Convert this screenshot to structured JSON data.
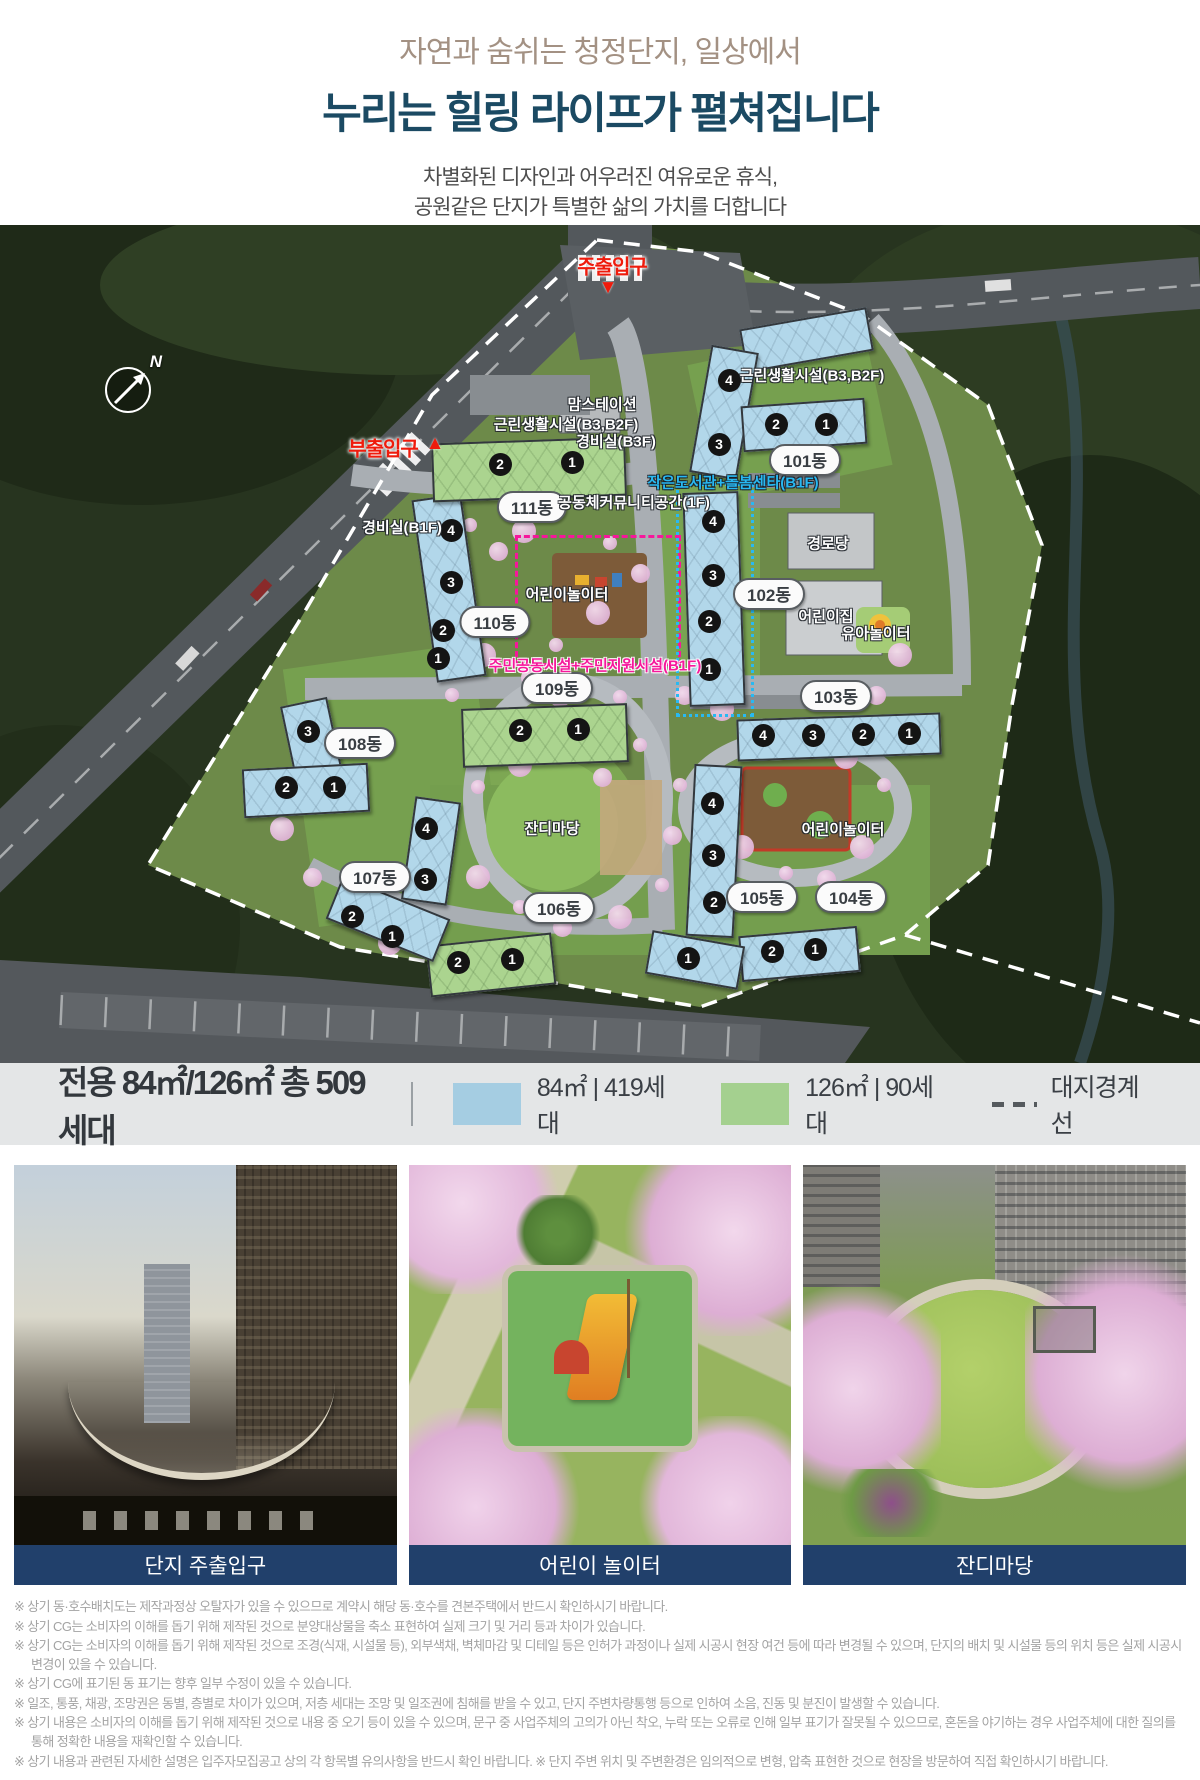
{
  "header": {
    "line1": "자연과 숨쉬는 청정단지, 일상에서",
    "line2": "누리는 힐링 라이프가 펼쳐집니다",
    "line3": "차별화된 디자인과 어우러진 여유로운 휴식,",
    "line4": "공원같은 단지가 특별한 삶의 가치를 더합니다"
  },
  "map": {
    "compass_label": "N",
    "entrances": [
      {
        "label": "주출입구",
        "x": 612,
        "y": 40,
        "dir": "down",
        "tx": 608,
        "ty": 63
      },
      {
        "label": "부출입구",
        "x": 383,
        "y": 222,
        "dir": "up",
        "tx": 435,
        "ty": 219
      }
    ],
    "pills": [
      {
        "label": "101동",
        "x": 805,
        "y": 235
      },
      {
        "label": "102동",
        "x": 769,
        "y": 369
      },
      {
        "label": "103동",
        "x": 836,
        "y": 471
      },
      {
        "label": "104동",
        "x": 851,
        "y": 672
      },
      {
        "label": "105동",
        "x": 762,
        "y": 672
      },
      {
        "label": "106동",
        "x": 559,
        "y": 683
      },
      {
        "label": "107동",
        "x": 375,
        "y": 652
      },
      {
        "label": "108동",
        "x": 360,
        "y": 518
      },
      {
        "label": "109동",
        "x": 557,
        "y": 463
      },
      {
        "label": "110동",
        "x": 495,
        "y": 397
      },
      {
        "label": "111동",
        "x": 532,
        "y": 282
      }
    ],
    "labels": [
      {
        "text": "맘스테이션",
        "style": "white",
        "x": 602,
        "y": 179
      },
      {
        "text": "근린생활시설(B3,B2F)",
        "style": "white",
        "x": 566,
        "y": 199
      },
      {
        "text": "경비실(B3F)",
        "style": "white",
        "x": 616,
        "y": 216
      },
      {
        "text": "근린생활시설(B3,B2F)",
        "style": "white",
        "x": 812,
        "y": 150
      },
      {
        "text": "경비실(B1F)",
        "style": "white",
        "x": 402,
        "y": 302
      },
      {
        "text": "공동체커뮤니티공간(1F)",
        "style": "white",
        "x": 634,
        "y": 277
      },
      {
        "text": "경로당",
        "style": "white",
        "x": 828,
        "y": 318
      },
      {
        "text": "어린이집",
        "style": "white",
        "x": 826,
        "y": 391
      },
      {
        "text": "유아놀이터",
        "style": "white",
        "x": 876,
        "y": 408
      },
      {
        "text": "어린이놀이터",
        "style": "white",
        "x": 567,
        "y": 369
      },
      {
        "text": "잔디마당",
        "style": "white",
        "x": 552,
        "y": 603
      },
      {
        "text": "어린이놀이터",
        "style": "white",
        "x": 843,
        "y": 604
      },
      {
        "text": "작은도서관+돌봄센타(B1F)",
        "style": "cyan",
        "x": 733,
        "y": 257
      },
      {
        "text": "주민공동시설+주민지원시설(B1F)",
        "style": "magenta",
        "x": 595,
        "y": 440
      }
    ],
    "buildings": [
      {
        "dong": "101",
        "color": "blue",
        "parts": [
          {
            "x": 742,
            "y": 93,
            "w": 125,
            "h": 40,
            "rot": -10
          },
          {
            "x": 700,
            "y": 123,
            "w": 44,
            "h": 125,
            "rot": 10
          },
          {
            "x": 742,
            "y": 177,
            "w": 120,
            "h": 42,
            "rot": -4
          }
        ],
        "units": [
          {
            "n": "4",
            "x": 729,
            "y": 155
          },
          {
            "n": "3",
            "x": 719,
            "y": 219
          },
          {
            "n": "2",
            "x": 776,
            "y": 199
          },
          {
            "n": "1",
            "x": 826,
            "y": 199
          }
        ]
      },
      {
        "dong": "102",
        "color": "blue",
        "parts": [
          {
            "x": 686,
            "y": 267,
            "w": 52,
            "h": 210,
            "rot": -2
          }
        ],
        "units": [
          {
            "n": "4",
            "x": 713,
            "y": 296
          },
          {
            "n": "3",
            "x": 713,
            "y": 350
          },
          {
            "n": "2",
            "x": 709,
            "y": 396
          },
          {
            "n": "1",
            "x": 709,
            "y": 444
          }
        ]
      },
      {
        "dong": "103",
        "color": "blue",
        "parts": [
          {
            "x": 737,
            "y": 491,
            "w": 200,
            "h": 38,
            "rot": -2
          }
        ],
        "units": [
          {
            "n": "4",
            "x": 763,
            "y": 510
          },
          {
            "n": "3",
            "x": 813,
            "y": 510
          },
          {
            "n": "2",
            "x": 863,
            "y": 509
          },
          {
            "n": "1",
            "x": 909,
            "y": 508
          }
        ]
      },
      {
        "dong": "104",
        "color": "blue",
        "parts": [
          {
            "x": 740,
            "y": 706,
            "w": 115,
            "h": 42,
            "rot": -5
          }
        ],
        "units": [
          {
            "n": "2",
            "x": 772,
            "y": 726
          },
          {
            "n": "1",
            "x": 815,
            "y": 724
          }
        ]
      },
      {
        "dong": "105",
        "color": "blue",
        "parts": [
          {
            "x": 690,
            "y": 540,
            "w": 44,
            "h": 168,
            "rot": 3
          },
          {
            "x": 648,
            "y": 713,
            "w": 90,
            "h": 40,
            "rot": 10
          }
        ],
        "units": [
          {
            "n": "4",
            "x": 712,
            "y": 578
          },
          {
            "n": "3",
            "x": 713,
            "y": 630
          },
          {
            "n": "2",
            "x": 714,
            "y": 677
          },
          {
            "n": "1",
            "x": 688,
            "y": 733
          }
        ]
      },
      {
        "dong": "106",
        "color": "green",
        "parts": [
          {
            "x": 428,
            "y": 714,
            "w": 122,
            "h": 48,
            "rot": -6
          }
        ],
        "units": [
          {
            "n": "2",
            "x": 458,
            "y": 737
          },
          {
            "n": "1",
            "x": 512,
            "y": 734
          }
        ]
      },
      {
        "dong": "107",
        "color": "blue",
        "parts": [
          {
            "x": 408,
            "y": 574,
            "w": 42,
            "h": 100,
            "rot": 8
          },
          {
            "x": 330,
            "y": 671,
            "w": 112,
            "h": 42,
            "rot": 22
          }
        ],
        "units": [
          {
            "n": "4",
            "x": 426,
            "y": 603
          },
          {
            "n": "3",
            "x": 425,
            "y": 654
          },
          {
            "n": "2",
            "x": 352,
            "y": 691
          },
          {
            "n": "1",
            "x": 392,
            "y": 711
          }
        ]
      },
      {
        "dong": "108",
        "color": "blue",
        "parts": [
          {
            "x": 288,
            "y": 476,
            "w": 44,
            "h": 78,
            "rot": -12
          },
          {
            "x": 243,
            "y": 541,
            "w": 122,
            "h": 45,
            "rot": -3
          }
        ],
        "units": [
          {
            "n": "3",
            "x": 308,
            "y": 506
          },
          {
            "n": "2",
            "x": 286,
            "y": 562
          },
          {
            "n": "1",
            "x": 334,
            "y": 562
          }
        ]
      },
      {
        "dong": "109",
        "color": "green",
        "parts": [
          {
            "x": 462,
            "y": 481,
            "w": 162,
            "h": 55,
            "rot": -2
          }
        ],
        "units": [
          {
            "n": "2",
            "x": 520,
            "y": 505
          },
          {
            "n": "1",
            "x": 578,
            "y": 504
          }
        ]
      },
      {
        "dong": "110",
        "color": "blue",
        "parts": [
          {
            "x": 424,
            "y": 271,
            "w": 46,
            "h": 180,
            "rot": -8
          }
        ],
        "units": [
          {
            "n": "4",
            "x": 451,
            "y": 305
          },
          {
            "n": "3",
            "x": 451,
            "y": 357
          },
          {
            "n": "2",
            "x": 443,
            "y": 405
          },
          {
            "n": "1",
            "x": 438,
            "y": 433
          }
        ]
      },
      {
        "dong": "111",
        "color": "green",
        "parts": [
          {
            "x": 432,
            "y": 215,
            "w": 190,
            "h": 55,
            "rot": -2
          }
        ],
        "units": [
          {
            "n": "2",
            "x": 500,
            "y": 239
          },
          {
            "n": "1",
            "x": 572,
            "y": 237
          }
        ]
      }
    ]
  },
  "legend": {
    "title": "전용 84㎡/126㎡ 총 509세대",
    "items": [
      {
        "color": "#a5cde2",
        "label": "84㎡ | 419세대"
      },
      {
        "color": "#a4d08f",
        "label": "126㎡ | 90세대"
      }
    ],
    "boundary_label": "대지경계선"
  },
  "photos": [
    {
      "caption": "단지 주출입구"
    },
    {
      "caption": "어린이 놀이터"
    },
    {
      "caption": "잔디마당"
    }
  ],
  "disclaimers": [
    "※ 상기 동·호수배치도는 제작과정상 오탈자가 있을 수 있으므로 계약시 해당 동·호수를 견본주택에서 반드시 확인하시기 바랍니다.",
    "※ 상기 CG는 소비자의 이해를 돕기 위해 제작된 것으로 분양대상물을 축소 표현하여 실제 크기 및 거리 등과 차이가 있습니다.",
    "※ 상기 CG는 소비자의 이해를 돕기 위해 제작된 것으로 조경(식재, 시설물 등), 외부색채, 벽체마감 및 디테일 등은 인허가 과정이나 실제 시공시 현장 여건 등에 따라 변경될 수 있으며, 단지의 배치 및 시설물 등의 위치 등은 실제 시공시 변경이 있을 수 있습니다.",
    "※ 상기 CG에 표기된 동 표기는 향후 일부 수정이 있을 수 있습니다.",
    "※ 일조, 통풍, 채광, 조망권은 동별, 층별로 차이가 있으며, 저층 세대는 조망 및 일조권에 침해를 받을 수 있고, 단지 주변차량통행 등으로 인하여 소음, 진동 및 분진이 발생할 수 있습니다.",
    "※ 상기 내용은 소비자의 이해를 돕기 위해 제작된 것으로 내용 중 오기 등이 있을 수 있으며, 문구 중 사업주체의 고의가 아닌 착오, 누락 또는 오류로 인해 일부 표기가 잘못될 수 있으므로, 혼돈을 야기하는 경우 사업주체에 대한 질의를 통해 정확한 내용을 재확인할 수 있습니다.",
    "※ 상기 내용과 관련된 자세한 설명은 입주자모집공고 상의 각 항목별 유의사항을 반드시 확인 바랍니다. ※ 단지 주변 위치 및 주변환경은 임의적으로 변형, 압축 표현한 것으로 현장을 방문하여 직접 확인하시기 바랍니다."
  ]
}
